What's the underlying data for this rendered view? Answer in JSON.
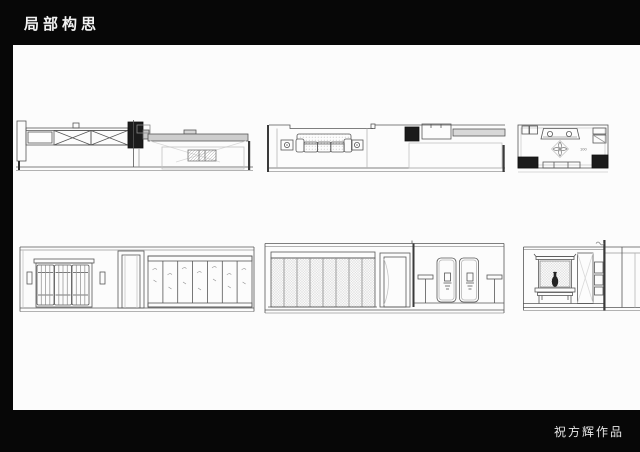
{
  "header": {
    "title": "局部构思"
  },
  "footer": {
    "signature": "祝方辉作品"
  },
  "sheet": {
    "ceiling_plan": {
      "dim_label": "100"
    }
  },
  "colors": {
    "canvas_background": "#070707",
    "sheet_background": "#fcfcfc",
    "line": "#565656",
    "dark_fill": "#1b1b1b",
    "light_fill": "#cdcdcd"
  }
}
